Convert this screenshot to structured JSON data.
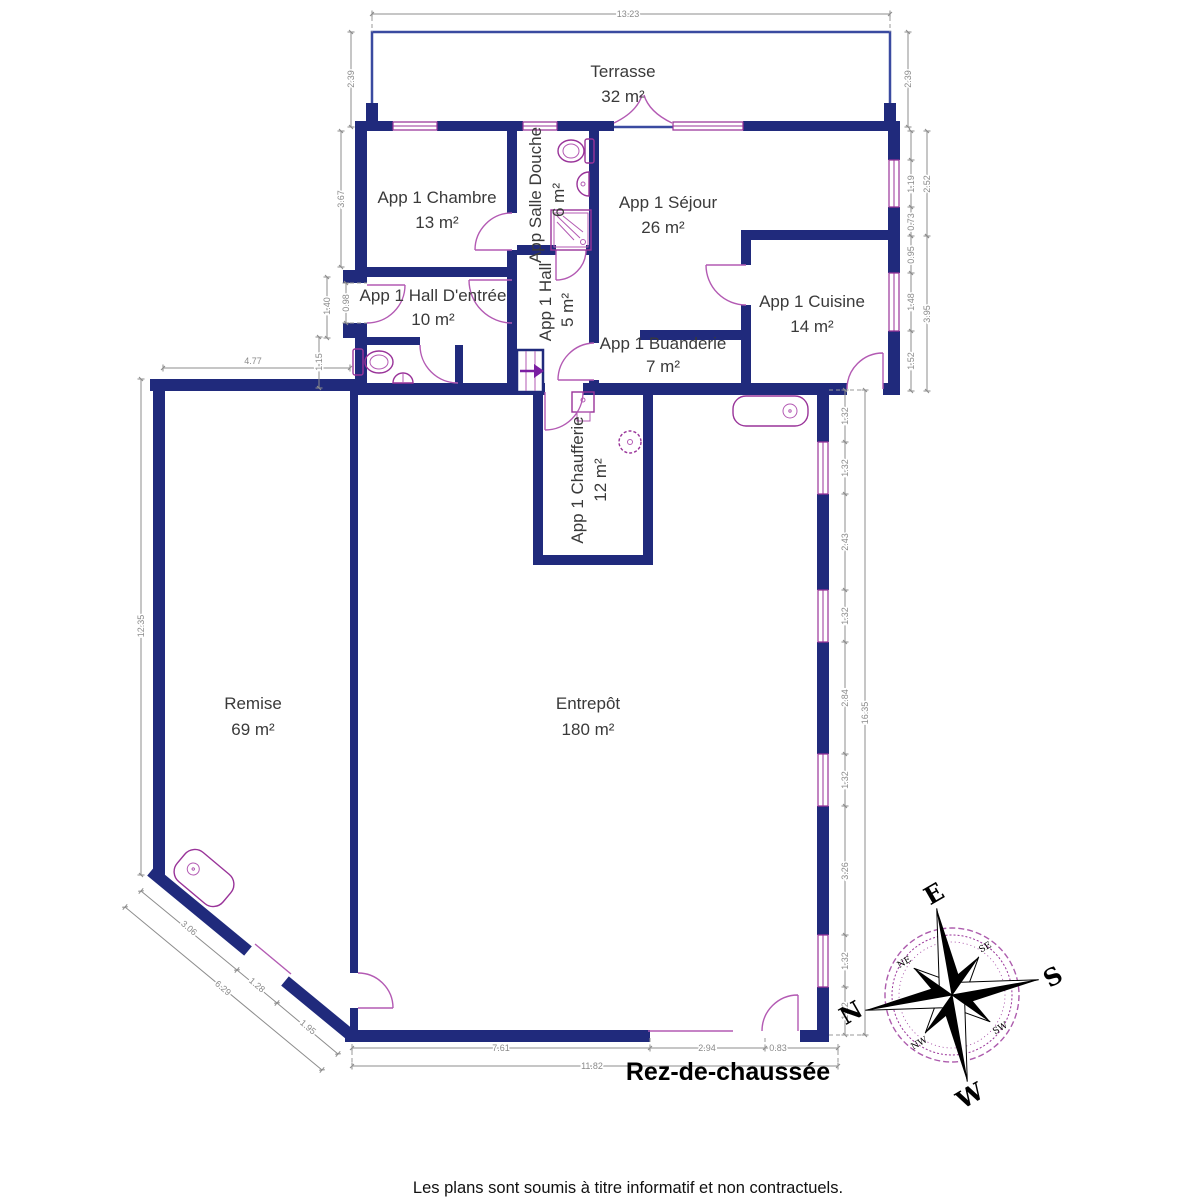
{
  "title": "Rez-de-chaussée",
  "footer": "Les plans sont soumis à titre informatif et non contractuels.",
  "rooms": {
    "terrasse": {
      "name": "Terrasse",
      "area": "32 m²"
    },
    "chambre": {
      "name": "App 1 Chambre",
      "area": "13 m²"
    },
    "salle_douche": {
      "name": "App Salle Douche",
      "area": "6 m²"
    },
    "sejour": {
      "name": "App 1 Séjour",
      "area": "26 m²"
    },
    "hall_entree": {
      "name": "App 1 Hall D'entrée",
      "area": "10 m²"
    },
    "hall": {
      "name": "App 1 Hall",
      "area": "5 m²"
    },
    "cuisine": {
      "name": "App 1 Cuisine",
      "area": "14 m²"
    },
    "buanderie": {
      "name": "App 1 Buanderie",
      "area": "7 m²"
    },
    "chaufferie": {
      "name": "App 1 Chaufferie",
      "area": "12 m²"
    },
    "remise": {
      "name": "Remise",
      "area": "69 m²"
    },
    "entrepot": {
      "name": "Entrepôt",
      "area": "180 m²"
    }
  },
  "dimensions": {
    "top_width": "13.23",
    "terrasse_left": "2.39",
    "terrasse_right": "2.39",
    "chambre_left": "3.67",
    "entry_left": [
      "1.40",
      "0.98",
      "1.15"
    ],
    "remise_top": "4.77",
    "remise_left": "12.35",
    "sejour_right": [
      "1.19",
      "0.73",
      "2.52"
    ],
    "cuisine_right": [
      "0.95",
      "1.48",
      "1.52",
      "3.95"
    ],
    "entrepot_right": [
      "1.32",
      "1.32",
      "2.43",
      "1.32",
      "2.84",
      "1.32",
      "3.26",
      "1.32",
      "1.22"
    ],
    "entrepot_right_total": "16.35",
    "diagonal": [
      "3.06",
      "1.28",
      "1.95"
    ],
    "diagonal_total": "6.29",
    "bottom": [
      "7.61",
      "2.94",
      "0.83"
    ],
    "bottom_total": "11.82"
  },
  "compass": {
    "cardinal": [
      "N",
      "E",
      "S",
      "W"
    ],
    "intercardinal": [
      "NE",
      "SE",
      "SW",
      "NW"
    ]
  },
  "colors": {
    "wall": "#202a7c",
    "fixture": "#993399",
    "dimension": "#8c8c8c"
  }
}
